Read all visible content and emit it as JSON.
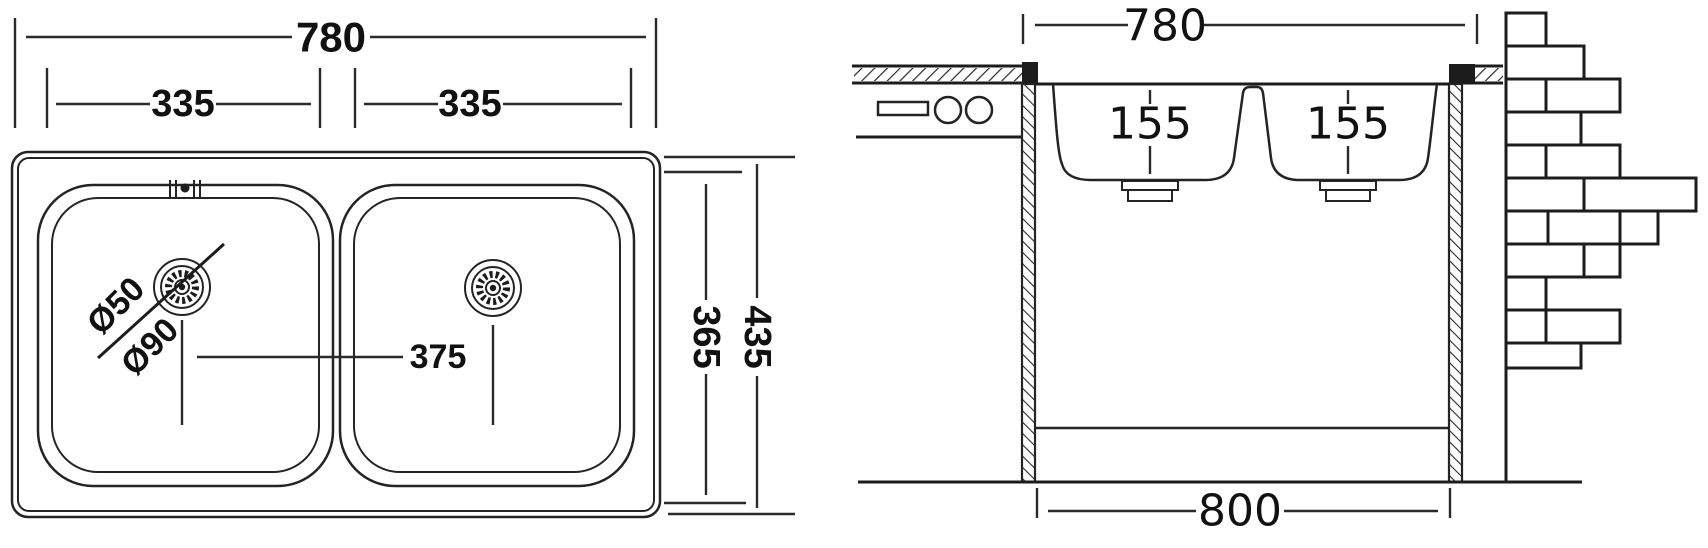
{
  "drawing": {
    "subject": "double-bowl kitchen sink dimensional drawing",
    "top_view": {
      "overall_width_mm": "780",
      "left_bowl_width_mm": "335",
      "right_bowl_width_mm": "335",
      "overall_depth_mm": "435",
      "bowl_zone_depth_mm": "365",
      "drain_spacing_mm": "375",
      "drain_hole_diameter": "Ø50",
      "drain_flange_diameter": "Ø90"
    },
    "section_view": {
      "sink_width_mm": "780",
      "left_bowl_depth_mm": "155",
      "right_bowl_depth_mm": "155",
      "cabinet_width_mm": "800"
    }
  }
}
